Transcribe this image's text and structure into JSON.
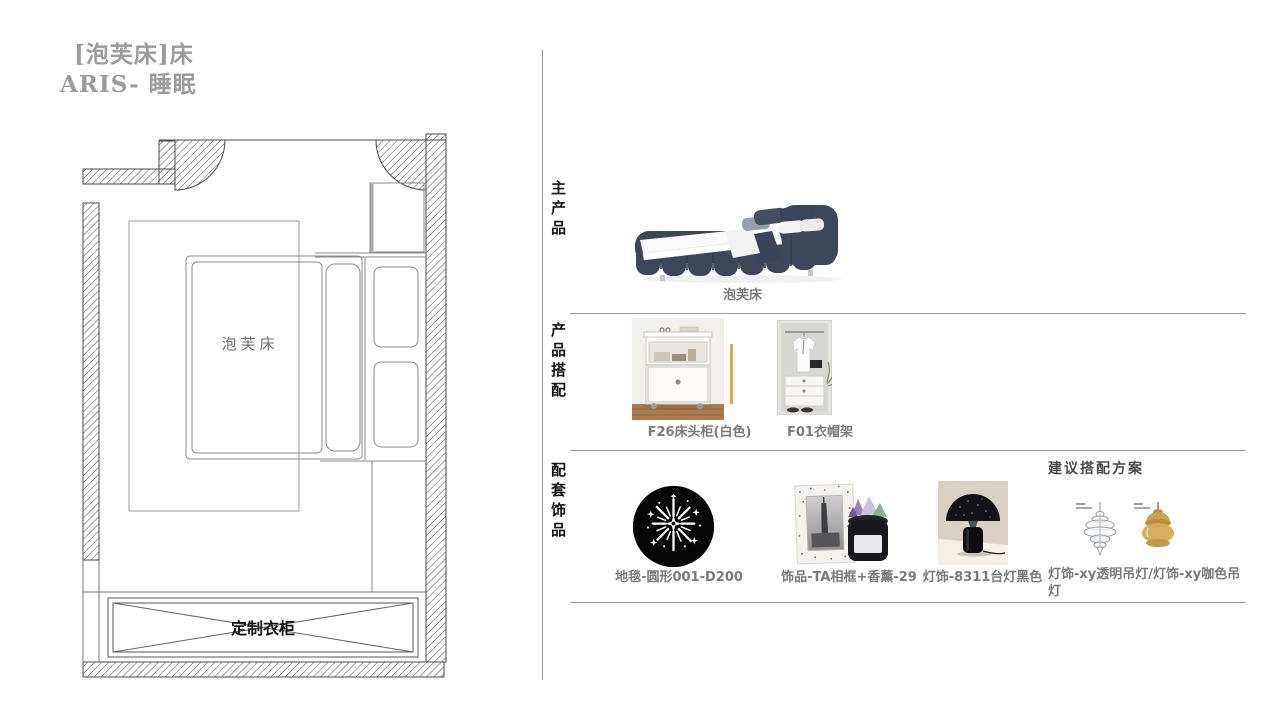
{
  "title": {
    "line1": "[泡芙床]床",
    "line2": "ARIS- 睡眠"
  },
  "floor_plan": {
    "bed_label": "泡芙床",
    "wardrobe_label": "定制衣柜"
  },
  "sections": {
    "main_product": {
      "label": "主产品",
      "product_name": "泡芙床"
    },
    "product_match": {
      "label": "产品搭配",
      "items": [
        {
          "name": "F26床头柜(白色)"
        },
        {
          "name": "F01衣帽架"
        }
      ]
    },
    "accessories": {
      "label": "配套饰品",
      "note": "建议搭配方案",
      "items": [
        {
          "name": "地毯-圆形001-D200"
        },
        {
          "name": "饰品-TA相框+香薰-29"
        },
        {
          "name": "灯饰-8311台灯黑色"
        },
        {
          "name": "灯饰-xy透明吊灯/灯饰-xy咖色吊灯"
        }
      ]
    }
  },
  "colors": {
    "accent_line": "#E8A33D",
    "bed_fabric": "#3D4759",
    "divider": "#999999",
    "label_gray": "#7A7A7A",
    "title_gray": "#9B9B9B",
    "plan_line": "#555555"
  }
}
